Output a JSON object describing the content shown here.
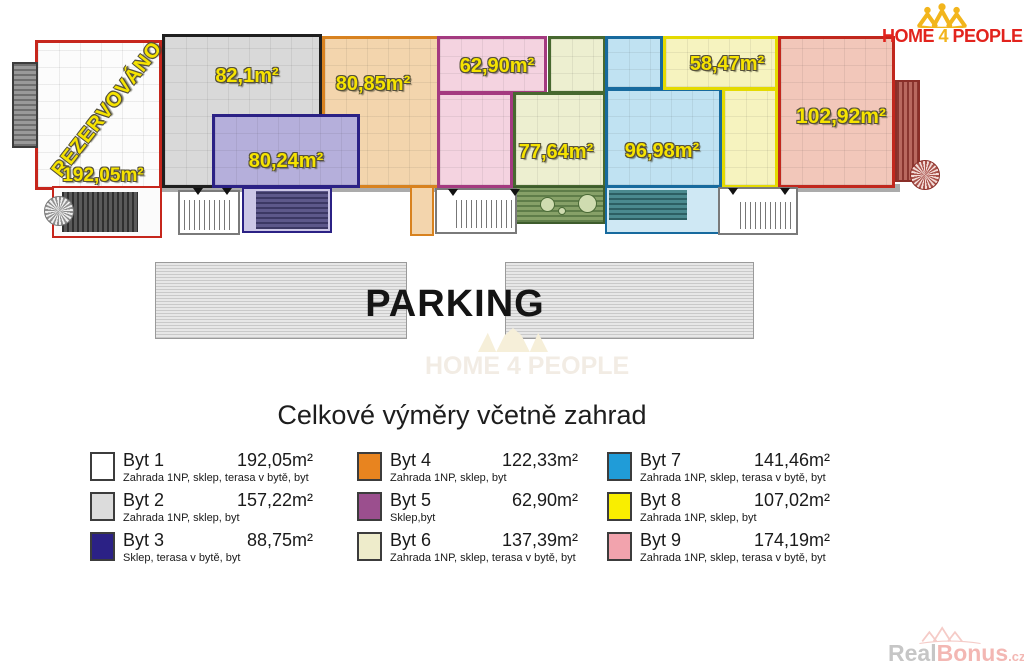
{
  "logo": {
    "home": "HOME",
    "four": "4",
    "people": "PEOPLE",
    "red": "#e2231d",
    "gold": "#f2b51c"
  },
  "plan": {
    "reserved_label": "REZERVOVÁNO",
    "label_color": "#f6e300",
    "units": [
      {
        "label": "192,05m²",
        "fill": "#fcfcfc",
        "border": "#c6261c"
      },
      {
        "label": "82,1m²",
        "fill": "#d9d9d9",
        "border": "#1f1f1f"
      },
      {
        "label": "80,24m²",
        "fill": "#b5afdb",
        "border": "#2b2185"
      },
      {
        "label": "80,85m²",
        "fill": "#f3d5ad",
        "border": "#d8821f"
      },
      {
        "label": "62,90m²",
        "fill": "#f4d3e0",
        "border": "#a43a80"
      },
      {
        "label": "77,64m²",
        "fill": "#edefd0",
        "border": "#47682f"
      },
      {
        "label": "96,98m²",
        "fill": "#c0e2f2",
        "border": "#176a9e"
      },
      {
        "label": "58,47m²",
        "fill": "#f6f3bf",
        "border": "#e4da00"
      },
      {
        "label": "102,92m²",
        "fill": "#f2c7ba",
        "border": "#c1271d"
      }
    ]
  },
  "parking": {
    "label": "PARKING"
  },
  "center_watermark": {
    "text": "HOME 4 PEOPLE"
  },
  "legend": {
    "title": "Celkové výměry včetně zahrad",
    "items": [
      {
        "name": "Byt 1",
        "area": "192,05m²",
        "desc": "Zahrada 1NP, sklep, terasa v bytě, byt",
        "color": "#ffffff"
      },
      {
        "name": "Byt 2",
        "area": "157,22m²",
        "desc": "Zahrada 1NP, sklep, byt",
        "color": "#dcdcdc"
      },
      {
        "name": "Byt 3",
        "area": "88,75m²",
        "desc": "Sklep, terasa v bytě, byt",
        "color": "#2b2185"
      },
      {
        "name": "Byt 4",
        "area": "122,33m²",
        "desc": "Zahrada 1NP, sklep, byt",
        "color": "#e8841f"
      },
      {
        "name": "Byt 5",
        "area": "62,90m²",
        "desc": "Sklep,byt",
        "color": "#9b4f8e"
      },
      {
        "name": "Byt 6",
        "area": "137,39m²",
        "desc": "Zahrada 1NP, sklep, terasa v bytě, byt",
        "color": "#eeeccb"
      },
      {
        "name": "Byt 7",
        "area": "141,46m²",
        "desc": "Zahrada 1NP, sklep, terasa v bytě, byt",
        "color": "#209cd8"
      },
      {
        "name": "Byt 8",
        "area": "107,02m²",
        "desc": "Zahrada 1NP, sklep, byt",
        "color": "#f9ee00"
      },
      {
        "name": "Byt 9",
        "area": "174,19m²",
        "desc": "Zahrada 1NP, sklep, terasa v bytě, byt",
        "color": "#f2a3ad"
      }
    ]
  },
  "footer_watermark": {
    "gray": "Real",
    "accent": "Bonus",
    "tld": ".cz"
  }
}
